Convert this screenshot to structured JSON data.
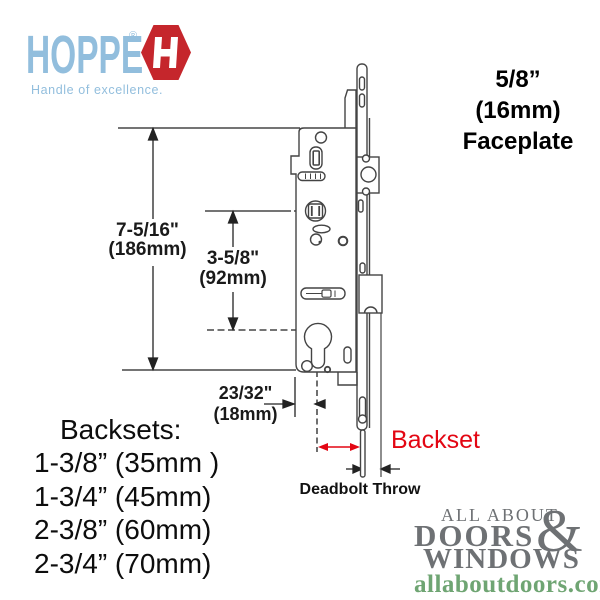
{
  "hoppe_logo": {
    "brand": "HOPPE",
    "registered": "®",
    "tagline": "Handle of excellence."
  },
  "faceplate_note": {
    "size": "5/8”",
    "metric": "(16mm)",
    "label": "Faceplate"
  },
  "dimensions": {
    "height_total": {
      "imperial": "7-5/16\"",
      "metric": "(186mm)"
    },
    "height_cylinder": {
      "imperial": "3-5/8\"",
      "metric": "(92mm)"
    },
    "offset": {
      "imperial": "23/32\"",
      "metric": "(18mm)"
    },
    "backset_label": "Backset",
    "deadbolt_throw_label": "Deadbolt Throw"
  },
  "backsets": {
    "title": "Backsets:",
    "items": [
      "1-3/8” (35mm )",
      "1-3/4” (45mm)",
      "2-3/8” (60mm)",
      "2-3/4” (70mm)"
    ]
  },
  "watermark": {
    "line1": "ALL ABOUT",
    "line2": "DOORS",
    "amp": "&",
    "line3": "WINDOWS",
    "site": "allaboutdoors.com"
  },
  "colors": {
    "hoppe_blue": "#92bedd",
    "hoppe_red": "#c5262c",
    "dimension_red": "#e30613",
    "watermark_gray": "#6e7174",
    "watermark_green": "#6fa573",
    "drawing_line": "#444444"
  }
}
